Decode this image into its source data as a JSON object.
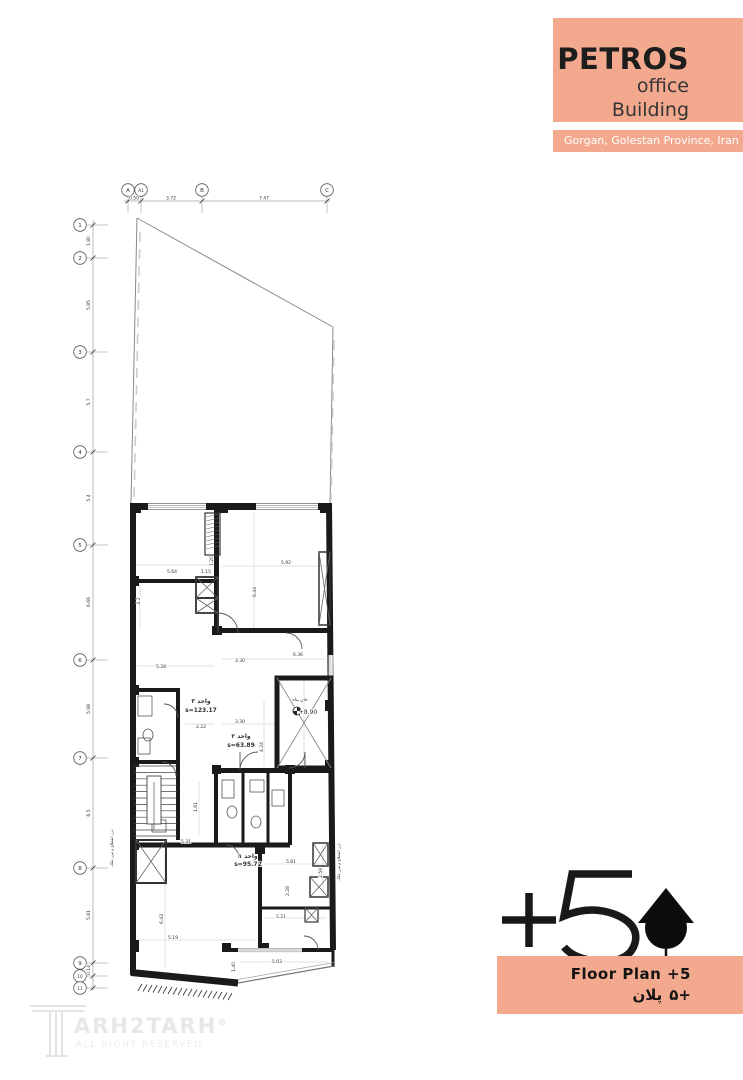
{
  "colors": {
    "accent": "#F2A98D",
    "ink": "#1a1a1a",
    "line_light": "#999999"
  },
  "title_block": {
    "name": "PETROS",
    "line2": "office",
    "line3": "Building"
  },
  "location_bar": {
    "text": "Gorgan, Golestan Province, Iran"
  },
  "floor_badge": {
    "level": "+5",
    "north_icon": "north-arrow"
  },
  "footer_bar": {
    "label_en": "Floor Plan +5",
    "label_fa_word": "پلان",
    "label_fa_num": "۵+"
  },
  "watermark": {
    "brand": "TARH2TARH",
    "brand_rest": "ARH2TARH",
    "reg": "®",
    "tagline": "ALL RIGHT RESERVED"
  },
  "plan": {
    "grid_cols": [
      {
        "id": "A",
        "x": 128
      },
      {
        "id": "A1",
        "x": 141
      },
      {
        "id": "B",
        "x": 202
      },
      {
        "id": "C",
        "x": 327
      }
    ],
    "col_dims": [
      {
        "t": "0.50",
        "x": 134
      },
      {
        "t": "3.72",
        "x": 171
      },
      {
        "t": "7.47",
        "x": 264
      }
    ],
    "grid_rows": [
      {
        "id": "1",
        "y": 225
      },
      {
        "id": "2",
        "y": 258
      },
      {
        "id": "3",
        "y": 352
      },
      {
        "id": "4",
        "y": 452
      },
      {
        "id": "5",
        "y": 545
      },
      {
        "id": "6",
        "y": 660
      },
      {
        "id": "7",
        "y": 758
      },
      {
        "id": "8",
        "y": 868
      },
      {
        "id": "9",
        "y": 963
      },
      {
        "id": "10",
        "y": 976
      },
      {
        "id": "11",
        "y": 988
      }
    ],
    "row_dims": [
      {
        "t": "1.80",
        "y": 241
      },
      {
        "t": "5.85",
        "y": 305
      },
      {
        "t": "5.7",
        "y": 402
      },
      {
        "t": "5.4",
        "y": 498
      },
      {
        "t": "6.66",
        "y": 602
      },
      {
        "t": "5.98",
        "y": 709
      },
      {
        "t": "6.5",
        "y": 813
      },
      {
        "t": "5.81",
        "y": 915
      },
      {
        "t": "0.14",
        "y": 970
      }
    ],
    "dim_labels": [
      {
        "t": "5.64",
        "x": 172,
        "y": 573
      },
      {
        "t": "1.15",
        "x": 206,
        "y": 573
      },
      {
        "t": "1.20",
        "x": 213,
        "y": 561,
        "r": -90
      },
      {
        "t": "5.92",
        "x": 286,
        "y": 564
      },
      {
        "t": "6.44",
        "x": 256,
        "y": 592,
        "r": -90
      },
      {
        "t": "4.2",
        "x": 140,
        "y": 601,
        "r": -90
      },
      {
        "t": "5.28",
        "x": 161,
        "y": 668
      },
      {
        "t": "3.30",
        "x": 240,
        "y": 662
      },
      {
        "t": "6.36",
        "x": 298,
        "y": 656
      },
      {
        "t": "3.30",
        "x": 240,
        "y": 723
      },
      {
        "t": "2.22",
        "x": 201,
        "y": 728
      },
      {
        "t": "4.24",
        "x": 263,
        "y": 747,
        "r": -90
      },
      {
        "t": "1.61",
        "x": 197,
        "y": 807,
        "r": -90
      },
      {
        "t": "5.31",
        "x": 186,
        "y": 843
      },
      {
        "t": "5.81",
        "x": 291,
        "y": 863
      },
      {
        "t": "2.59",
        "x": 322,
        "y": 873,
        "r": -90
      },
      {
        "t": "6.43",
        "x": 163,
        "y": 919,
        "r": -90
      },
      {
        "t": "5.19",
        "x": 173,
        "y": 939
      },
      {
        "t": "5.21",
        "x": 281,
        "y": 918
      },
      {
        "t": "2.28",
        "x": 289,
        "y": 891,
        "r": -90
      },
      {
        "t": "5.03",
        "x": 277,
        "y": 963
      },
      {
        "t": "1.40",
        "x": 235,
        "y": 967,
        "r": -90
      }
    ],
    "room_labels": [
      {
        "t": "واحد ۳",
        "x": 201,
        "y": 703
      },
      {
        "t": "s=123.17",
        "x": 201,
        "y": 712
      },
      {
        "t": "واحد ۲",
        "x": 241,
        "y": 738
      },
      {
        "t": "s=63.89",
        "x": 241,
        "y": 747
      },
      {
        "t": "واحد ۱",
        "x": 248,
        "y": 858
      },
      {
        "t": "s=95.72",
        "x": 248,
        "y": 866
      }
    ],
    "annotations": [
      {
        "t": "+8.90",
        "x": 308,
        "y": 714,
        "s": 6
      },
      {
        "t": "جان پناه",
        "x": 300,
        "y": 701,
        "s": 4.5
      },
      {
        "t": "درز انقطاع و مرز ملک",
        "x": 113,
        "y": 848,
        "r": -90,
        "s": 4
      },
      {
        "t": "درز انقطاع و مرز ملک",
        "x": 340,
        "y": 862,
        "r": -90,
        "s": 4
      }
    ]
  }
}
